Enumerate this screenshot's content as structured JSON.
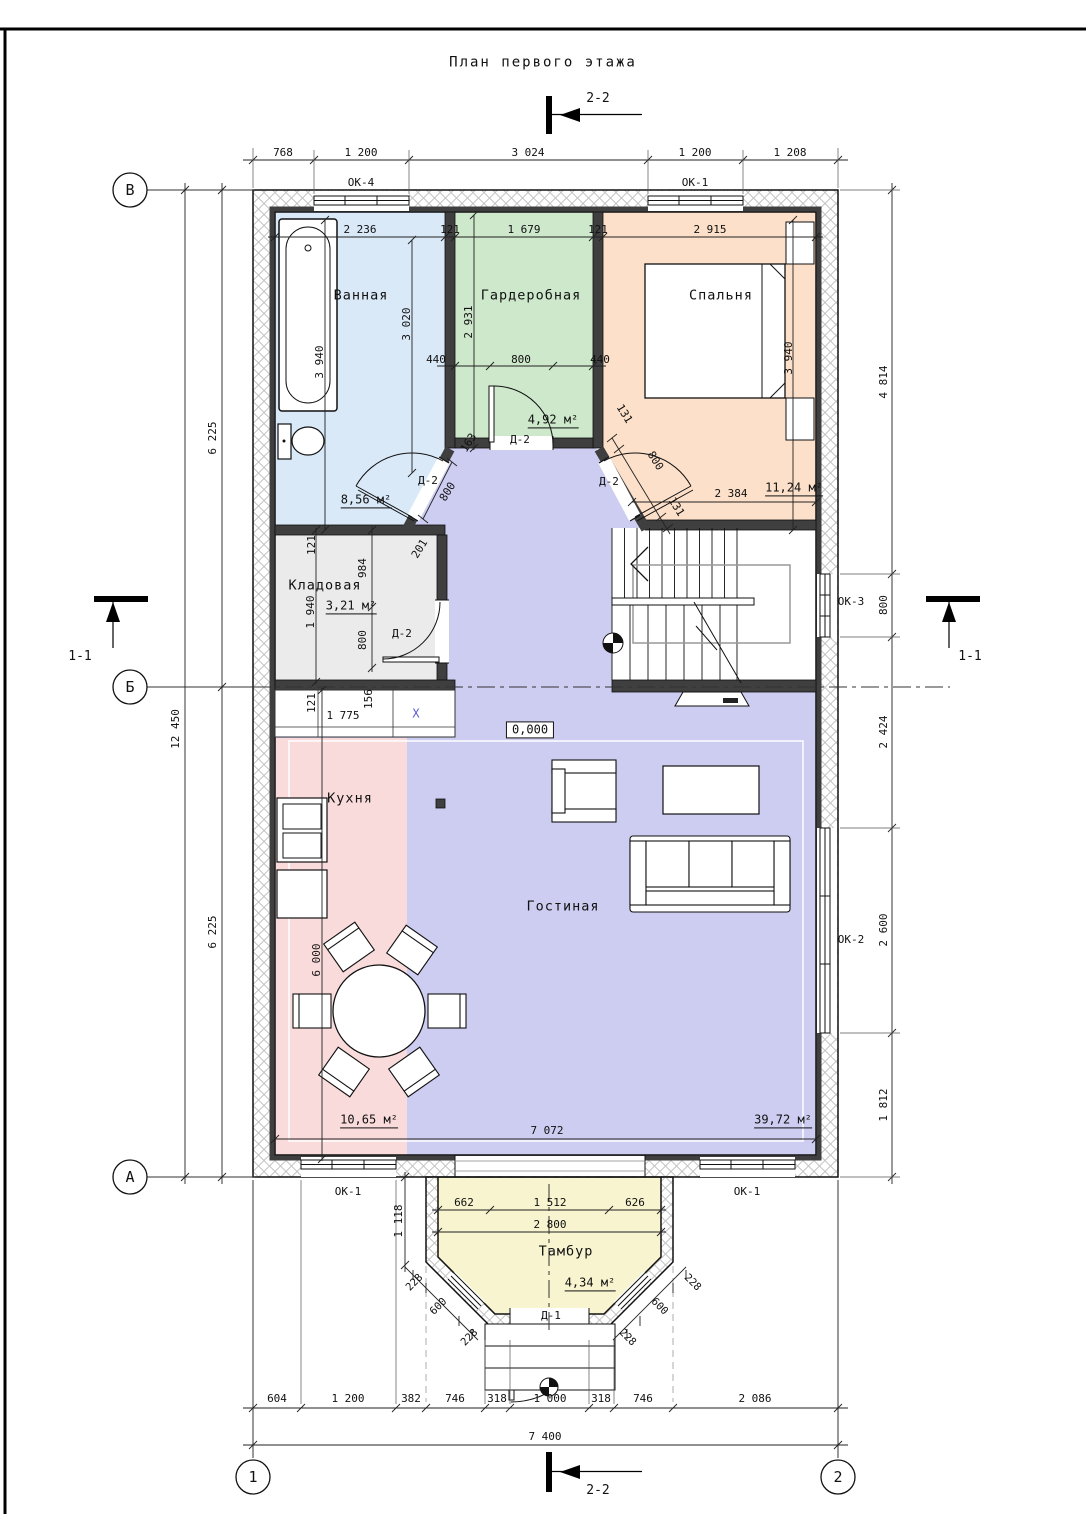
{
  "title": "План первого этажа",
  "section_marks": {
    "s11": "1-1",
    "s22": "2-2"
  },
  "axes": {
    "top": "В",
    "middle": "Б",
    "bottom": "А",
    "left": "1",
    "right": "2"
  },
  "elevation": "0,000",
  "x_mark": "X",
  "windows": {
    "ok1": "ОК-1",
    "ok2": "ОК-2",
    "ok3": "ОК-3",
    "ok4": "ОК-4"
  },
  "doors": {
    "d1": "Д-1",
    "d2": "Д-2"
  },
  "rooms": {
    "bathroom": {
      "name": "Ванная",
      "area": "8,56 м²"
    },
    "wardrobe": {
      "name": "Гардеробная",
      "area": "4,92 м²"
    },
    "bedroom": {
      "name": "Спальня",
      "area": "11,24 м²"
    },
    "storage": {
      "name": "Кладовая",
      "area": "3,21 м²"
    },
    "kitchen": {
      "name": "Кухня",
      "area": "10,65 м²"
    },
    "living": {
      "name": "Гостиная",
      "area": "39,72 м²"
    },
    "vestibule": {
      "name": "Тамбур",
      "area": "4,34 м²"
    }
  },
  "colors": {
    "bathroom": "#d9e9f8",
    "wardrobe": "#cde8cb",
    "bedroom": "#fce0c9",
    "storage": "#ebebeb",
    "kitchen": "#fadbdb",
    "living": "#cdccf1",
    "vestibule": "#f7f4cf",
    "wall": "#3f3f3f",
    "x_mark": "#5b5bd6"
  },
  "dims": {
    "top": [
      "768",
      "1 200",
      "3 024",
      "1 200",
      "1 208"
    ],
    "inner_top": [
      "2 236",
      "121",
      "1 679",
      "121",
      "2 915"
    ],
    "left": [
      "6 225",
      "6 225"
    ],
    "left_total": "12 450",
    "right": [
      "4 814",
      "800",
      "2 424",
      "2 600",
      "1 812"
    ],
    "bottom": [
      "604",
      "1 200",
      "382",
      "746",
      "318",
      "1 000",
      "318",
      "746",
      "2 086"
    ],
    "bottom_total": "7 400",
    "bathroom": {
      "height": "3 940",
      "width": "3 020",
      "door": "800"
    },
    "wardrobe": {
      "depth": "2 931",
      "door_chain": [
        "440",
        "800",
        "440"
      ],
      "jamb": "163"
    },
    "bedroom": {
      "depth": "3 940",
      "door_chain": [
        "131",
        "800",
        "131"
      ],
      "width": "2 384"
    },
    "storage": {
      "wall": "121",
      "upper": "984",
      "depth": "1 940",
      "door": "800",
      "diag": "201"
    },
    "kitchen": {
      "wall": "121",
      "counter": "1 775",
      "gap": "156",
      "height": "6 000"
    },
    "living": {
      "width": "7 072"
    },
    "vestibule": {
      "top_chain": [
        "662",
        "1 512",
        "626"
      ],
      "width": "2 800",
      "depth": "1 118",
      "diag": [
        "228",
        "600",
        "228"
      ]
    }
  }
}
